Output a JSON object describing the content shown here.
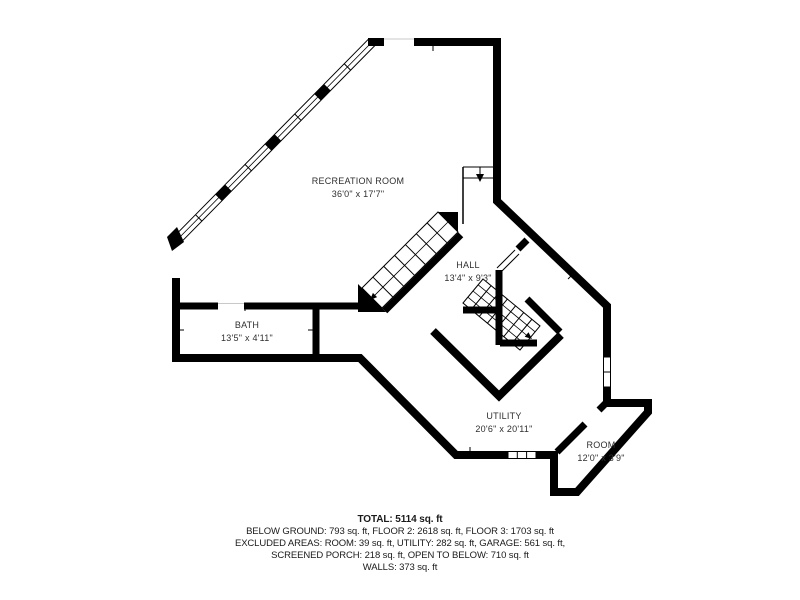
{
  "floorplan": {
    "rooms": [
      {
        "name": "RECREATION ROOM",
        "dims": "36'0\" x 17'7\""
      },
      {
        "name": "HALL",
        "dims": "13'4\" x 9'3\""
      },
      {
        "name": "BATH",
        "dims": "13'5\" x 4'11\""
      },
      {
        "name": "UTILITY",
        "dims": "20'6\" x 20'11\""
      },
      {
        "name": "ROOM",
        "dims": "12'0\" x 3'9\""
      }
    ],
    "summary": {
      "total": "TOTAL: 5114 sq. ft",
      "line2": "BELOW GROUND: 793 sq. ft, FLOOR 2: 2618 sq. ft, FLOOR 3: 1703 sq. ft",
      "line3": "EXCLUDED AREAS: ROOM: 39 sq. ft, UTILITY: 282 sq. ft, GARAGE: 561 sq. ft,",
      "line4": "SCREENED PORCH: 218 sq. ft, OPEN TO BELOW: 710 sq. ft",
      "line5": "WALLS: 373 sq. ft"
    },
    "colors": {
      "wall": "#000000",
      "background": "#ffffff",
      "label_text": "#2f2f2f"
    }
  }
}
